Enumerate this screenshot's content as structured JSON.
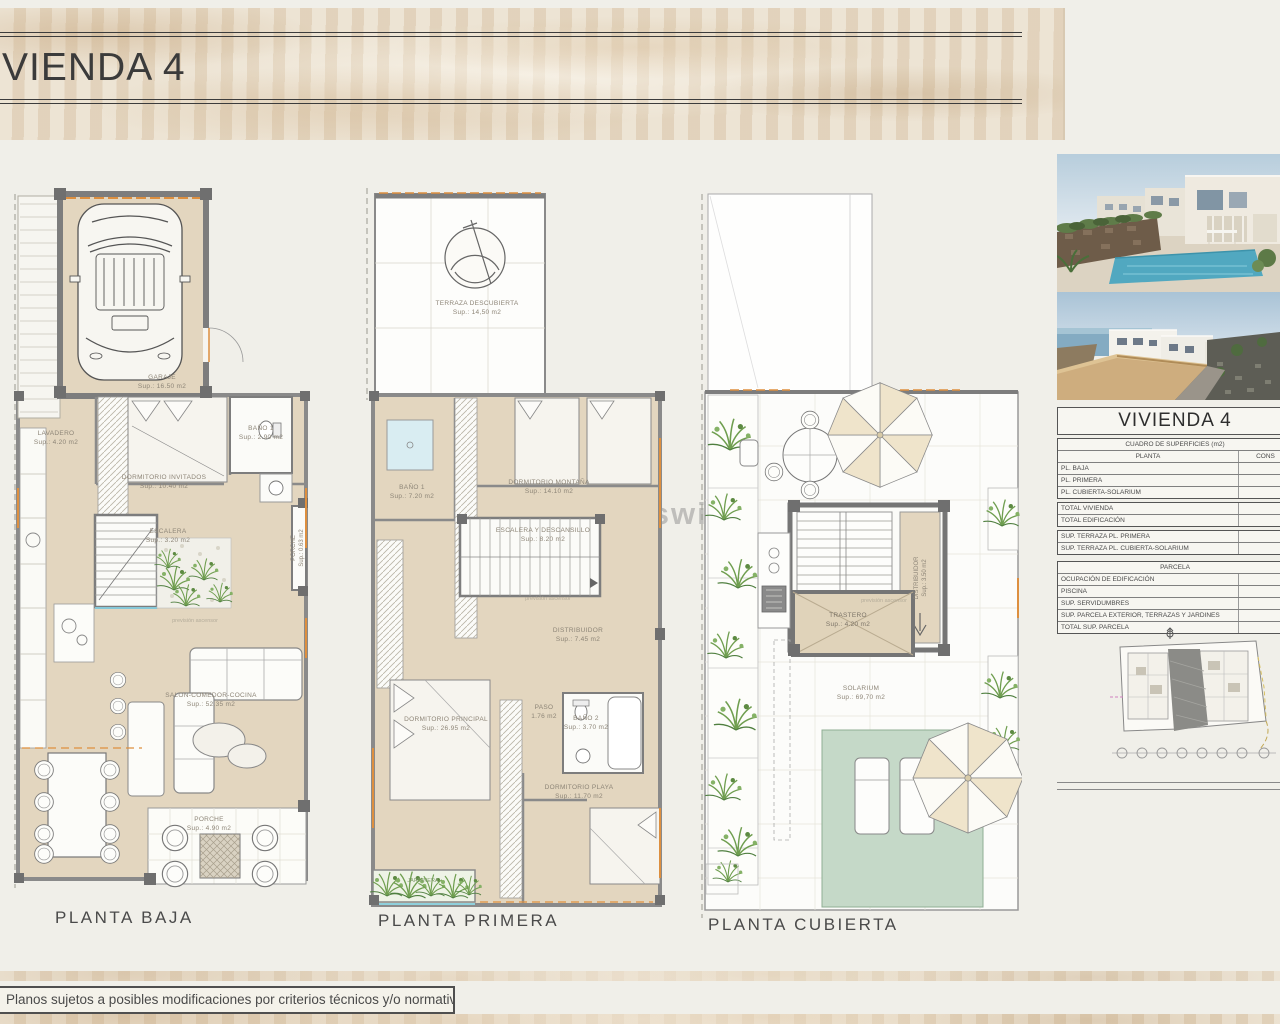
{
  "header": {
    "title": "VIENDA 4"
  },
  "watermark": "www.casaswilson.com",
  "plans": {
    "baja": {
      "name": "PLANTA BAJA",
      "rooms": {
        "garaje": {
          "label": "GARAJE",
          "area": "Sup.: 16.50  m2"
        },
        "lavadero": {
          "label": "LAVADERO",
          "area": "Sup.: 4.20  m2"
        },
        "dorm_invitados": {
          "label": "DORMITORIO INVITADOS",
          "area": "Sup.: 10.40  m2"
        },
        "banio1": {
          "label": "BAÑO 1",
          "area": "Sup.: 2.90  m2"
        },
        "escalera": {
          "label": "ESCALERA",
          "area": "Sup.: 3.20  m2"
        },
        "porche_lateral": {
          "label": "PORCHE",
          "area": "Sup.: 0.63 m2"
        },
        "salon": {
          "label": "SALON-COMEDOR-COCINA",
          "area": "Sup.: 52.35  m2"
        },
        "porche": {
          "label": "PORCHE",
          "area": "Sup.: 4.90  m2"
        },
        "ascensor": {
          "label": "previsión ascensor"
        }
      }
    },
    "primera": {
      "name": "PLANTA PRIMERA",
      "rooms": {
        "terraza": {
          "label": "TERRAZA DESCUBIERTA",
          "area": "Sup.: 14,50  m2"
        },
        "banio1": {
          "label": "BAÑO 1",
          "area": "Sup.: 7.20  m2"
        },
        "dorm_montana": {
          "label": "DORMITORIO MONTAÑA",
          "area": "Sup.: 14.10  m2"
        },
        "escalera": {
          "label": "ESCALERA Y DESCANSILLO",
          "area": "Sup.: 8.20  m2"
        },
        "distribuidor": {
          "label": "DISTRIBUIDOR",
          "area": "Sup.: 7.45  m2"
        },
        "dorm_principal": {
          "label": "DORMITORIO PRINCIPAL",
          "area": "Sup.: 26.95  m2"
        },
        "paso": {
          "label": "PASO",
          "area": "1.76 m2"
        },
        "banio2": {
          "label": "BAÑO 2",
          "area": "Sup.: 3.70  m2"
        },
        "dorm_playa": {
          "label": "DORMITORIO PLAYA",
          "area": "Sup.: 11.70  m2"
        },
        "jardinera": {
          "label": "JARDINERA"
        },
        "ascensor": {
          "label": "previsión ascensor"
        }
      }
    },
    "cubierta": {
      "name": "PLANTA CUBIERTA",
      "rooms": {
        "distribuidor": {
          "label": "DISTRIBUIDOR",
          "area": "Sup.: 3.50 m2"
        },
        "trastero": {
          "label": "TRASTERO",
          "area": "Sup.: 4.20  m2"
        },
        "solarium": {
          "label": "SOLARIUM",
          "area": "Sup.: 69,70  m2"
        },
        "ascensor": {
          "label": "previsión ascensor"
        }
      }
    }
  },
  "summary_table": {
    "title": "VIVIENDA 4",
    "header": "CUADRO DE SUPERFICIES (m2)",
    "columns": {
      "planta": "PLANTA",
      "construida": "CONS"
    },
    "rows": [
      {
        "label": "PL. BAJA",
        "value": "16"
      },
      {
        "label": "PL. PRIMERA",
        "value": "1"
      },
      {
        "label": "PL. CUBIERTA-SOLARIUM",
        "value": ""
      },
      {
        "label": "TOTAL VIVIENDA",
        "value": "21"
      },
      {
        "label": "TOTAL EDIFICACIÓN",
        "value": "21"
      },
      {
        "label": "SUP. TERRAZA PL. PRIMERA",
        "value": ""
      },
      {
        "label": "SUP. TERRAZA PL. CUBIERTA-SOLARIUM",
        "value": "6"
      }
    ],
    "parcela_header": "PARCELA",
    "parcela_rows": [
      {
        "label": "OCUPACIÓN DE EDIFICACIÓN",
        "value": "1"
      },
      {
        "label": "PISCINA",
        "value": "3"
      },
      {
        "label": "SUP. SERVIDUMBRES",
        "value": "5"
      },
      {
        "label": "SUP. PARCELA EXTERIOR, TERRAZAS Y JARDINES",
        "value": "12"
      },
      {
        "label": "TOTAL SUP. PARCELA",
        "value": "32"
      }
    ]
  },
  "footer": {
    "disclaimer": "Planos sujetos a posibles modificaciones por criterios técnicos y/o normativa sectorial."
  },
  "colors": {
    "floor_beige": "#e3d6bf",
    "wall_gray": "#7d7d7d",
    "accent_orange": "#dd8f3f",
    "shade_green": "#c5d9c8",
    "plant_green": "#6f9e4f"
  }
}
